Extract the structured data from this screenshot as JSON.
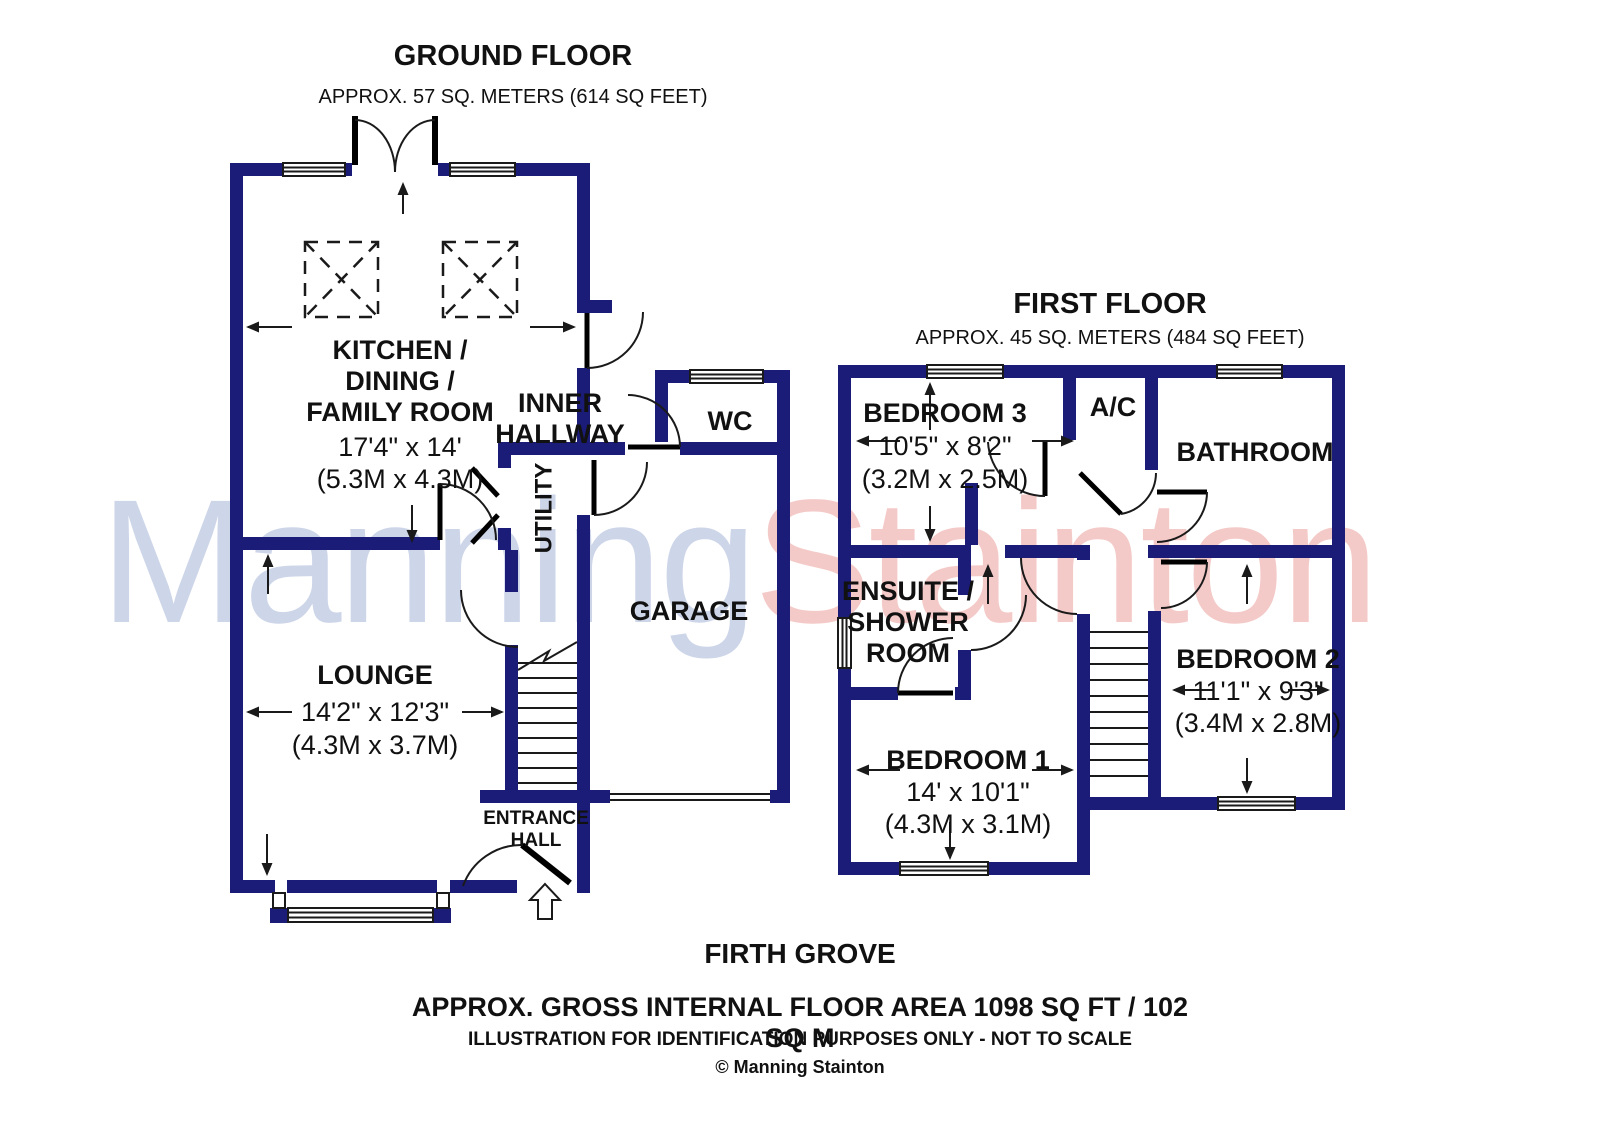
{
  "ground_floor": {
    "title": "GROUND FLOOR",
    "area": "APPROX. 57 SQ. METERS (614 SQ FEET)",
    "rooms": {
      "kitchen": {
        "name": "KITCHEN /\nDINING /\nFAMILY ROOM",
        "dims_imperial": "17'4\" x 14'",
        "dims_metric": "(5.3M x 4.3M)"
      },
      "inner_hallway": {
        "name": "INNER\nHALLWAY"
      },
      "wc": {
        "name": "WC"
      },
      "utility": {
        "name": "UTILITY"
      },
      "garage": {
        "name": "GARAGE"
      },
      "lounge": {
        "name": "LOUNGE",
        "dims_imperial": "14'2\" x 12'3\"",
        "dims_metric": "(4.3M x 3.7M)"
      },
      "entrance_hall": {
        "name": "ENTRANCE\nHALL"
      }
    }
  },
  "first_floor": {
    "title": "FIRST FLOOR",
    "area": "APPROX. 45 SQ. METERS (484 SQ FEET)",
    "rooms": {
      "bedroom3": {
        "name": "BEDROOM 3",
        "dims_imperial": "10'5\" x 8'2\"",
        "dims_metric": "(3.2M x 2.5M)"
      },
      "ac": {
        "name": "A/C"
      },
      "bathroom": {
        "name": "BATHROOM"
      },
      "ensuite": {
        "name": "ENSUITE /\nSHOWER\nROOM"
      },
      "bedroom2": {
        "name": "BEDROOM 2",
        "dims_imperial": "11'1\" x 9'3\"",
        "dims_metric": "(3.4M x 2.8M)"
      },
      "bedroom1": {
        "name": "BEDROOM 1",
        "dims_imperial": "14' x 10'1\"",
        "dims_metric": "(4.3M x 3.1M)"
      }
    }
  },
  "footer": {
    "property_name": "FIRTH GROVE",
    "total_area": "APPROX. GROSS INTERNAL FLOOR AREA 1098 SQ FT / 102 SQ M",
    "disclaimer": "ILLUSTRATION FOR IDENTIFICATION PURPOSES ONLY - NOT TO SCALE",
    "copyright": "© Manning Stainton"
  },
  "watermark": {
    "part1": "Manning",
    "part2": "Stainton"
  },
  "colors": {
    "wall": "#1b1b78",
    "line": "#1a1a1a",
    "watermark_blue": "#cdd5e9",
    "watermark_pink": "#f4cac8"
  }
}
